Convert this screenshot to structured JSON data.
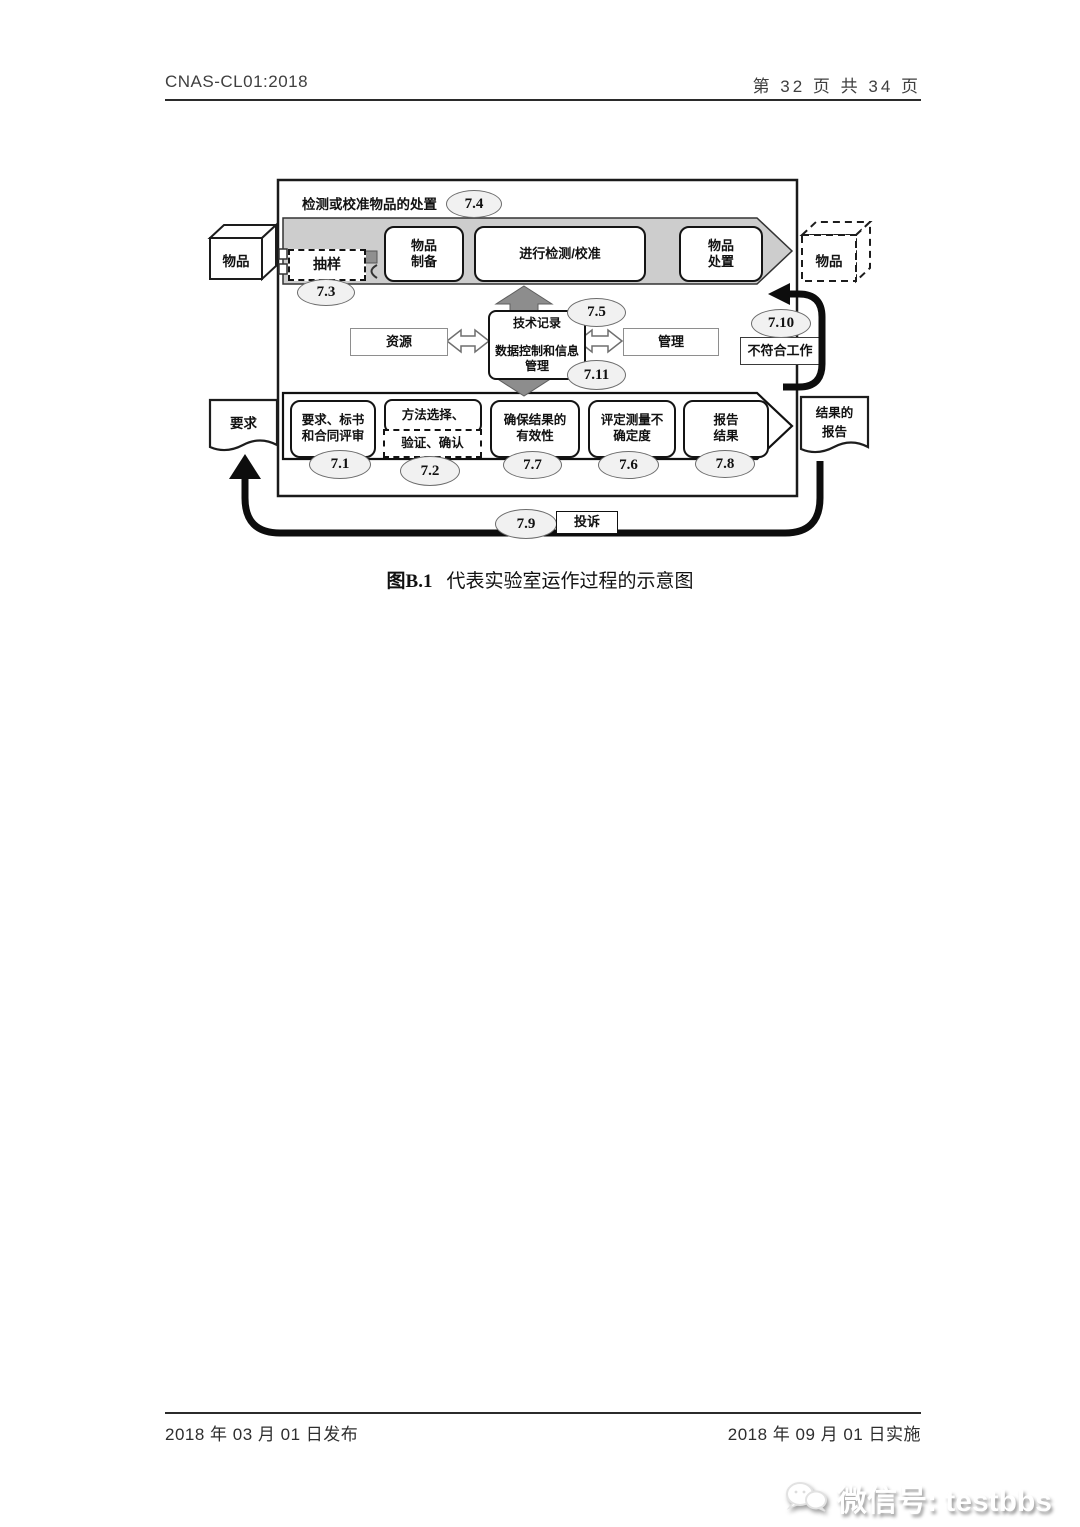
{
  "header": {
    "doc_id": "CNAS-CL01:2018",
    "page_info": "第 32 页 共 34 页"
  },
  "diagram": {
    "outer_label": "检测或校准物品的处置",
    "outer_badge": "7.4",
    "item_in": "物品",
    "item_out": "物品",
    "sampling": {
      "label": "抽样",
      "badge": "7.3"
    },
    "preparation": {
      "line1": "物品",
      "line2": "制备"
    },
    "testing": {
      "label": "进行检测/校准"
    },
    "disposal": {
      "line1": "物品",
      "line2": "处置"
    },
    "resources": {
      "label": "资源"
    },
    "records": {
      "line1": "技术记录",
      "line2": "数据控制和信息管理",
      "badge_top": "7.5",
      "badge_bottom": "7.11"
    },
    "management": {
      "label": "管理"
    },
    "nonconforming": {
      "label": "不符合工作",
      "badge": "7.10"
    },
    "request_doc": {
      "label": "要求"
    },
    "report_doc": {
      "line1": "结果的",
      "line2": "报告"
    },
    "review": {
      "line1": "要求、标书",
      "line2": "和合同评审",
      "badge": "7.1"
    },
    "method": {
      "line1": "方法选择、",
      "line2": "验证、确认",
      "badge": "7.2"
    },
    "validity": {
      "line1": "确保结果的",
      "line2": "有效性",
      "badge": "7.7"
    },
    "uncertainty": {
      "line1": "评定测量不",
      "line2": "确定度",
      "badge": "7.6"
    },
    "reporting": {
      "line1": "报告",
      "line2": "结果",
      "badge": "7.8"
    },
    "complaints": {
      "label": "投诉",
      "badge": "7.9"
    }
  },
  "caption": {
    "prefix": "图B.1",
    "title": "代表实验室运作过程的示意图"
  },
  "footer": {
    "release": "2018 年 03 月 01 日发布",
    "implement": "2018 年 09 月 01 日实施"
  },
  "watermark": {
    "label": "微信号: testbbs"
  },
  "colors": {
    "band_gray": "#cdcdcd",
    "arrow_gray": "#8d8d8d",
    "ink": "#111111"
  }
}
